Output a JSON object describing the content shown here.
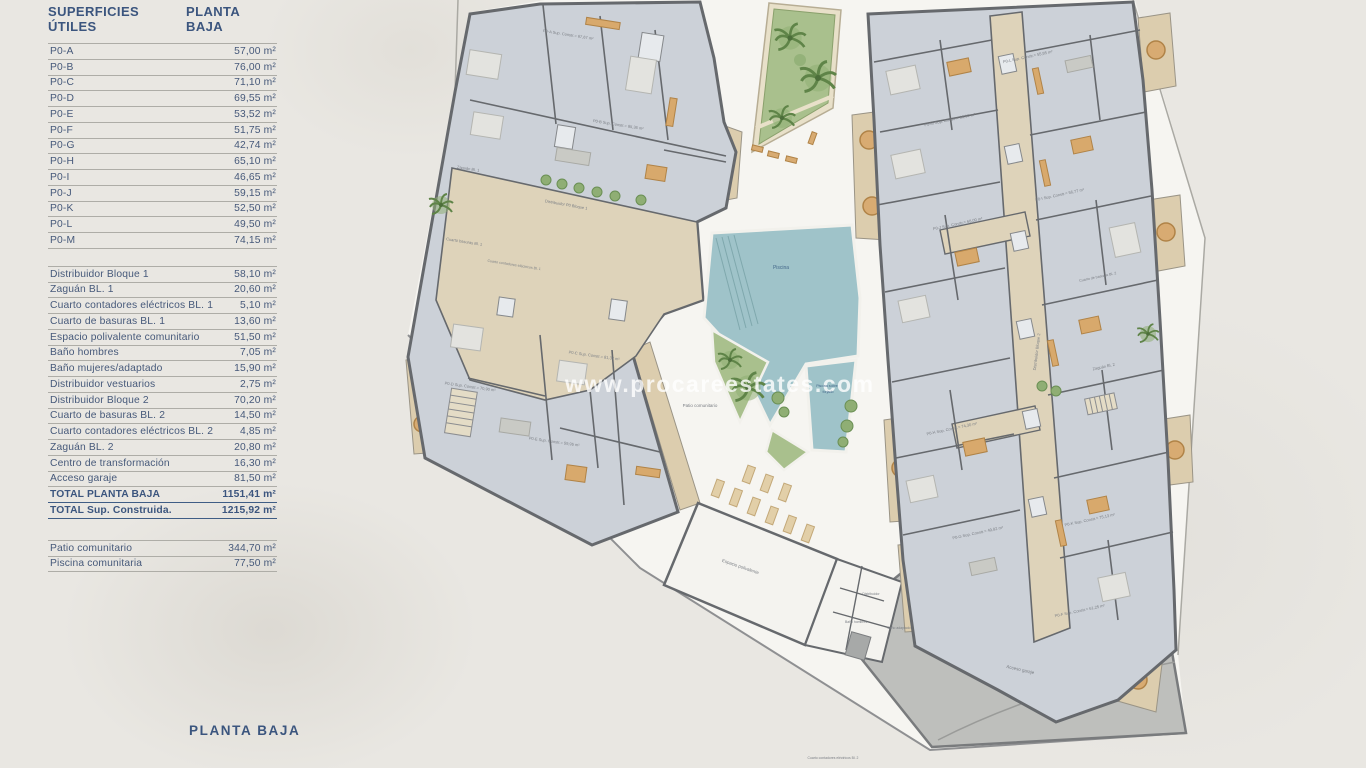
{
  "panel": {
    "header": {
      "col1": "SUPERFICIES ÚTILES",
      "col2": "PLANTA BAJA"
    },
    "units": {
      "rows": [
        {
          "label": "P0-A",
          "value": "57,00 m²"
        },
        {
          "label": "P0-B",
          "value": "76,00 m²"
        },
        {
          "label": "P0-C",
          "value": "71,10 m²"
        },
        {
          "label": "P0-D",
          "value": "69,55 m²"
        },
        {
          "label": "P0-E",
          "value": "53,52 m²"
        },
        {
          "label": "P0-F",
          "value": "51,75 m²"
        },
        {
          "label": "P0-G",
          "value": "42,74 m²"
        },
        {
          "label": "P0-H",
          "value": "65,10 m²"
        },
        {
          "label": "P0-I",
          "value": "46,65 m²"
        },
        {
          "label": "P0-J",
          "value": "59,15 m²"
        },
        {
          "label": "P0-K",
          "value": "52,50 m²"
        },
        {
          "label": "P0-L",
          "value": "49,50 m²"
        },
        {
          "label": "P0-M",
          "value": "74,15 m²"
        }
      ]
    },
    "common": {
      "rows": [
        {
          "label": "Distribuidor Bloque 1",
          "value": "58,10 m²"
        },
        {
          "label": "Zaguán BL. 1",
          "value": "20,60 m²"
        },
        {
          "label": "Cuarto contadores eléctricos BL. 1",
          "value": "5,10 m²"
        },
        {
          "label": "Cuarto de basuras BL. 1",
          "value": "13,60 m²"
        },
        {
          "label": "Espacio polivalente comunitario",
          "value": "51,50 m²"
        },
        {
          "label": "Baño hombres",
          "value": "7,05 m²"
        },
        {
          "label": "Baño mujeres/adaptado",
          "value": "15,90 m²"
        },
        {
          "label": "Distribuidor vestuarios",
          "value": "2,75 m²"
        },
        {
          "label": "Distribuidor Bloque 2",
          "value": "70,20 m²"
        },
        {
          "label": "Cuarto de basuras BL. 2",
          "value": "14,50 m²"
        },
        {
          "label": "Cuarto contadores eléctricos BL. 2",
          "value": "4,85 m²"
        },
        {
          "label": "Zaguán BL. 2",
          "value": "20,80 m²"
        },
        {
          "label": "Centro de transformación",
          "value": "16,30 m²"
        },
        {
          "label": "Acceso garaje",
          "value": "81,50 m²"
        }
      ],
      "totals": [
        {
          "label": "TOTAL PLANTA BAJA",
          "value": "1151,41 m²"
        },
        {
          "label": "TOTAL Sup. Construida.",
          "value": "1215,92 m²"
        }
      ]
    },
    "outdoor": {
      "rows": [
        {
          "label": "Patio comunitario",
          "value": "344,70 m²"
        },
        {
          "label": "Piscina comunitaria",
          "value": "77,50 m²"
        }
      ]
    }
  },
  "floor_label": "PLANTA BAJA",
  "watermark": "www.procareestates.com",
  "plan": {
    "labels": [
      {
        "text": "P0-A Sup. Constr.= 67,67 m²"
      },
      {
        "text": "P0-B Sup. Constr.= 85,36 m²"
      },
      {
        "text": "Zaguán Bl. 1"
      },
      {
        "text": "Distribuidor P0 Bloque 1"
      },
      {
        "text": "Cuarto basuras Bl. 1"
      },
      {
        "text": "Cuarto contadores eléctricos Bl. 1"
      },
      {
        "text": "P0-D Sup. Constr.= 70,90 m²"
      },
      {
        "text": "P0-C Sup. Constr.= 81,32 m²"
      },
      {
        "text": "P0-E Sup. Constr.= 59,95 m²"
      },
      {
        "text": "P0-L Sup. Constr.= 55,95 m²"
      },
      {
        "text": "P0-M Sup. Constr.= 85,00 m²"
      },
      {
        "text": "P0-I Sup. Constr.= 56,77 m²"
      },
      {
        "text": "P0-J Sup. Constr.= 68,00 m²"
      },
      {
        "text": "P0-H Sup. Constr.= 74,30 m²"
      },
      {
        "text": "P0-G Sup. Constr.= 49,82 m²"
      },
      {
        "text": "P0-K Sup. Constr.= 75,13 m²"
      },
      {
        "text": "P0-F Sup. Constr.= 61,25 m²"
      },
      {
        "text": "Distribuidor Bloque 2"
      },
      {
        "text": "Zaguán Bl. 2"
      },
      {
        "text": "Cuarto de basuras Bl. 2"
      },
      {
        "text": "Piscina"
      },
      {
        "text": "Piscina sobre"
      },
      {
        "text": "forjado"
      },
      {
        "text": "Patio comunitario"
      },
      {
        "text": "Espacio polivalente"
      },
      {
        "text": "Distribuidor"
      },
      {
        "text": "Baño hombres"
      },
      {
        "text": "Baño adaptado"
      },
      {
        "text": "Acceso garaje"
      },
      {
        "text": "Cuarto contadores eléctricos Bl. 2"
      }
    ]
  },
  "colors": {
    "background": "#e9e7e2",
    "site_ground": "#f6f5f1",
    "room_fill": "#ccd1d8",
    "wall": "#66696d",
    "corridor_beige": "#ded3ba",
    "terrace_beige": "#dccdae",
    "pool_blue": "#9fc3c9",
    "garden_green": "#a9c08d",
    "ramp_gray": "#bebfbc",
    "text_navy": "#3b557e",
    "watermark_white": "#ffffff"
  }
}
